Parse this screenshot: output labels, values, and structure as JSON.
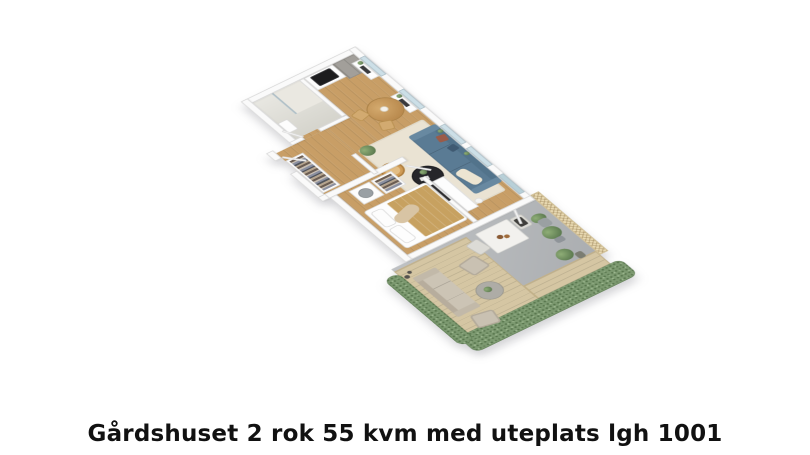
{
  "caption": {
    "text": "Gårdshuset 2 rok 55 kvm med uteplats lgh 1001"
  },
  "floorplan": {
    "view": "3d-isometric-apartment-render",
    "rooms": [
      {
        "name": "bathroom",
        "features": [
          "walk-in shower",
          "glass partition",
          "sink"
        ]
      },
      {
        "name": "kitchen",
        "features": [
          "tall gray cabinets",
          "white counter",
          "black cooktop",
          "window with sill plants"
        ]
      },
      {
        "name": "dining-area",
        "features": [
          "round wood table",
          "two chairs",
          "white flowers",
          "window bench"
        ]
      },
      {
        "name": "living-room",
        "features": [
          "blue sofa",
          "rust pillow",
          "cream throw",
          "beige rug",
          "round black coffee table",
          "two rattan chairs",
          "potted plant",
          "white sideboard",
          "windows"
        ]
      },
      {
        "name": "hallway",
        "features": [
          "open wardrobe with clothes",
          "entry door"
        ]
      },
      {
        "name": "bedroom",
        "features": [
          "double bed",
          "ochre blanket",
          "white pillows",
          "storage units with basket and clothes",
          "wall tv"
        ]
      },
      {
        "name": "patio",
        "features": [
          "gray concrete floor",
          "wood deck",
          "outdoor sofa",
          "two outdoor chairs",
          "round side table",
          "white dining table",
          "two patio chairs",
          "trellis fence",
          "hedge border",
          "potted plants"
        ]
      }
    ],
    "colors": {
      "background": "#ffffff",
      "walls": "#fafafa",
      "wood_floor": "#c89e66",
      "bath_floor": "#deddd5",
      "rug": "#eae3d3",
      "sofa_blue": "#5a7b94",
      "accent_pillow": "#9b5b48",
      "rattan": "#cf9b55",
      "blanket": "#c7a160",
      "concrete": "#b4b7ba",
      "deck": "#d5c6a3",
      "hedge": "#7c9970",
      "trellis": "#e8d9b2",
      "caption_text": "#111111"
    }
  }
}
